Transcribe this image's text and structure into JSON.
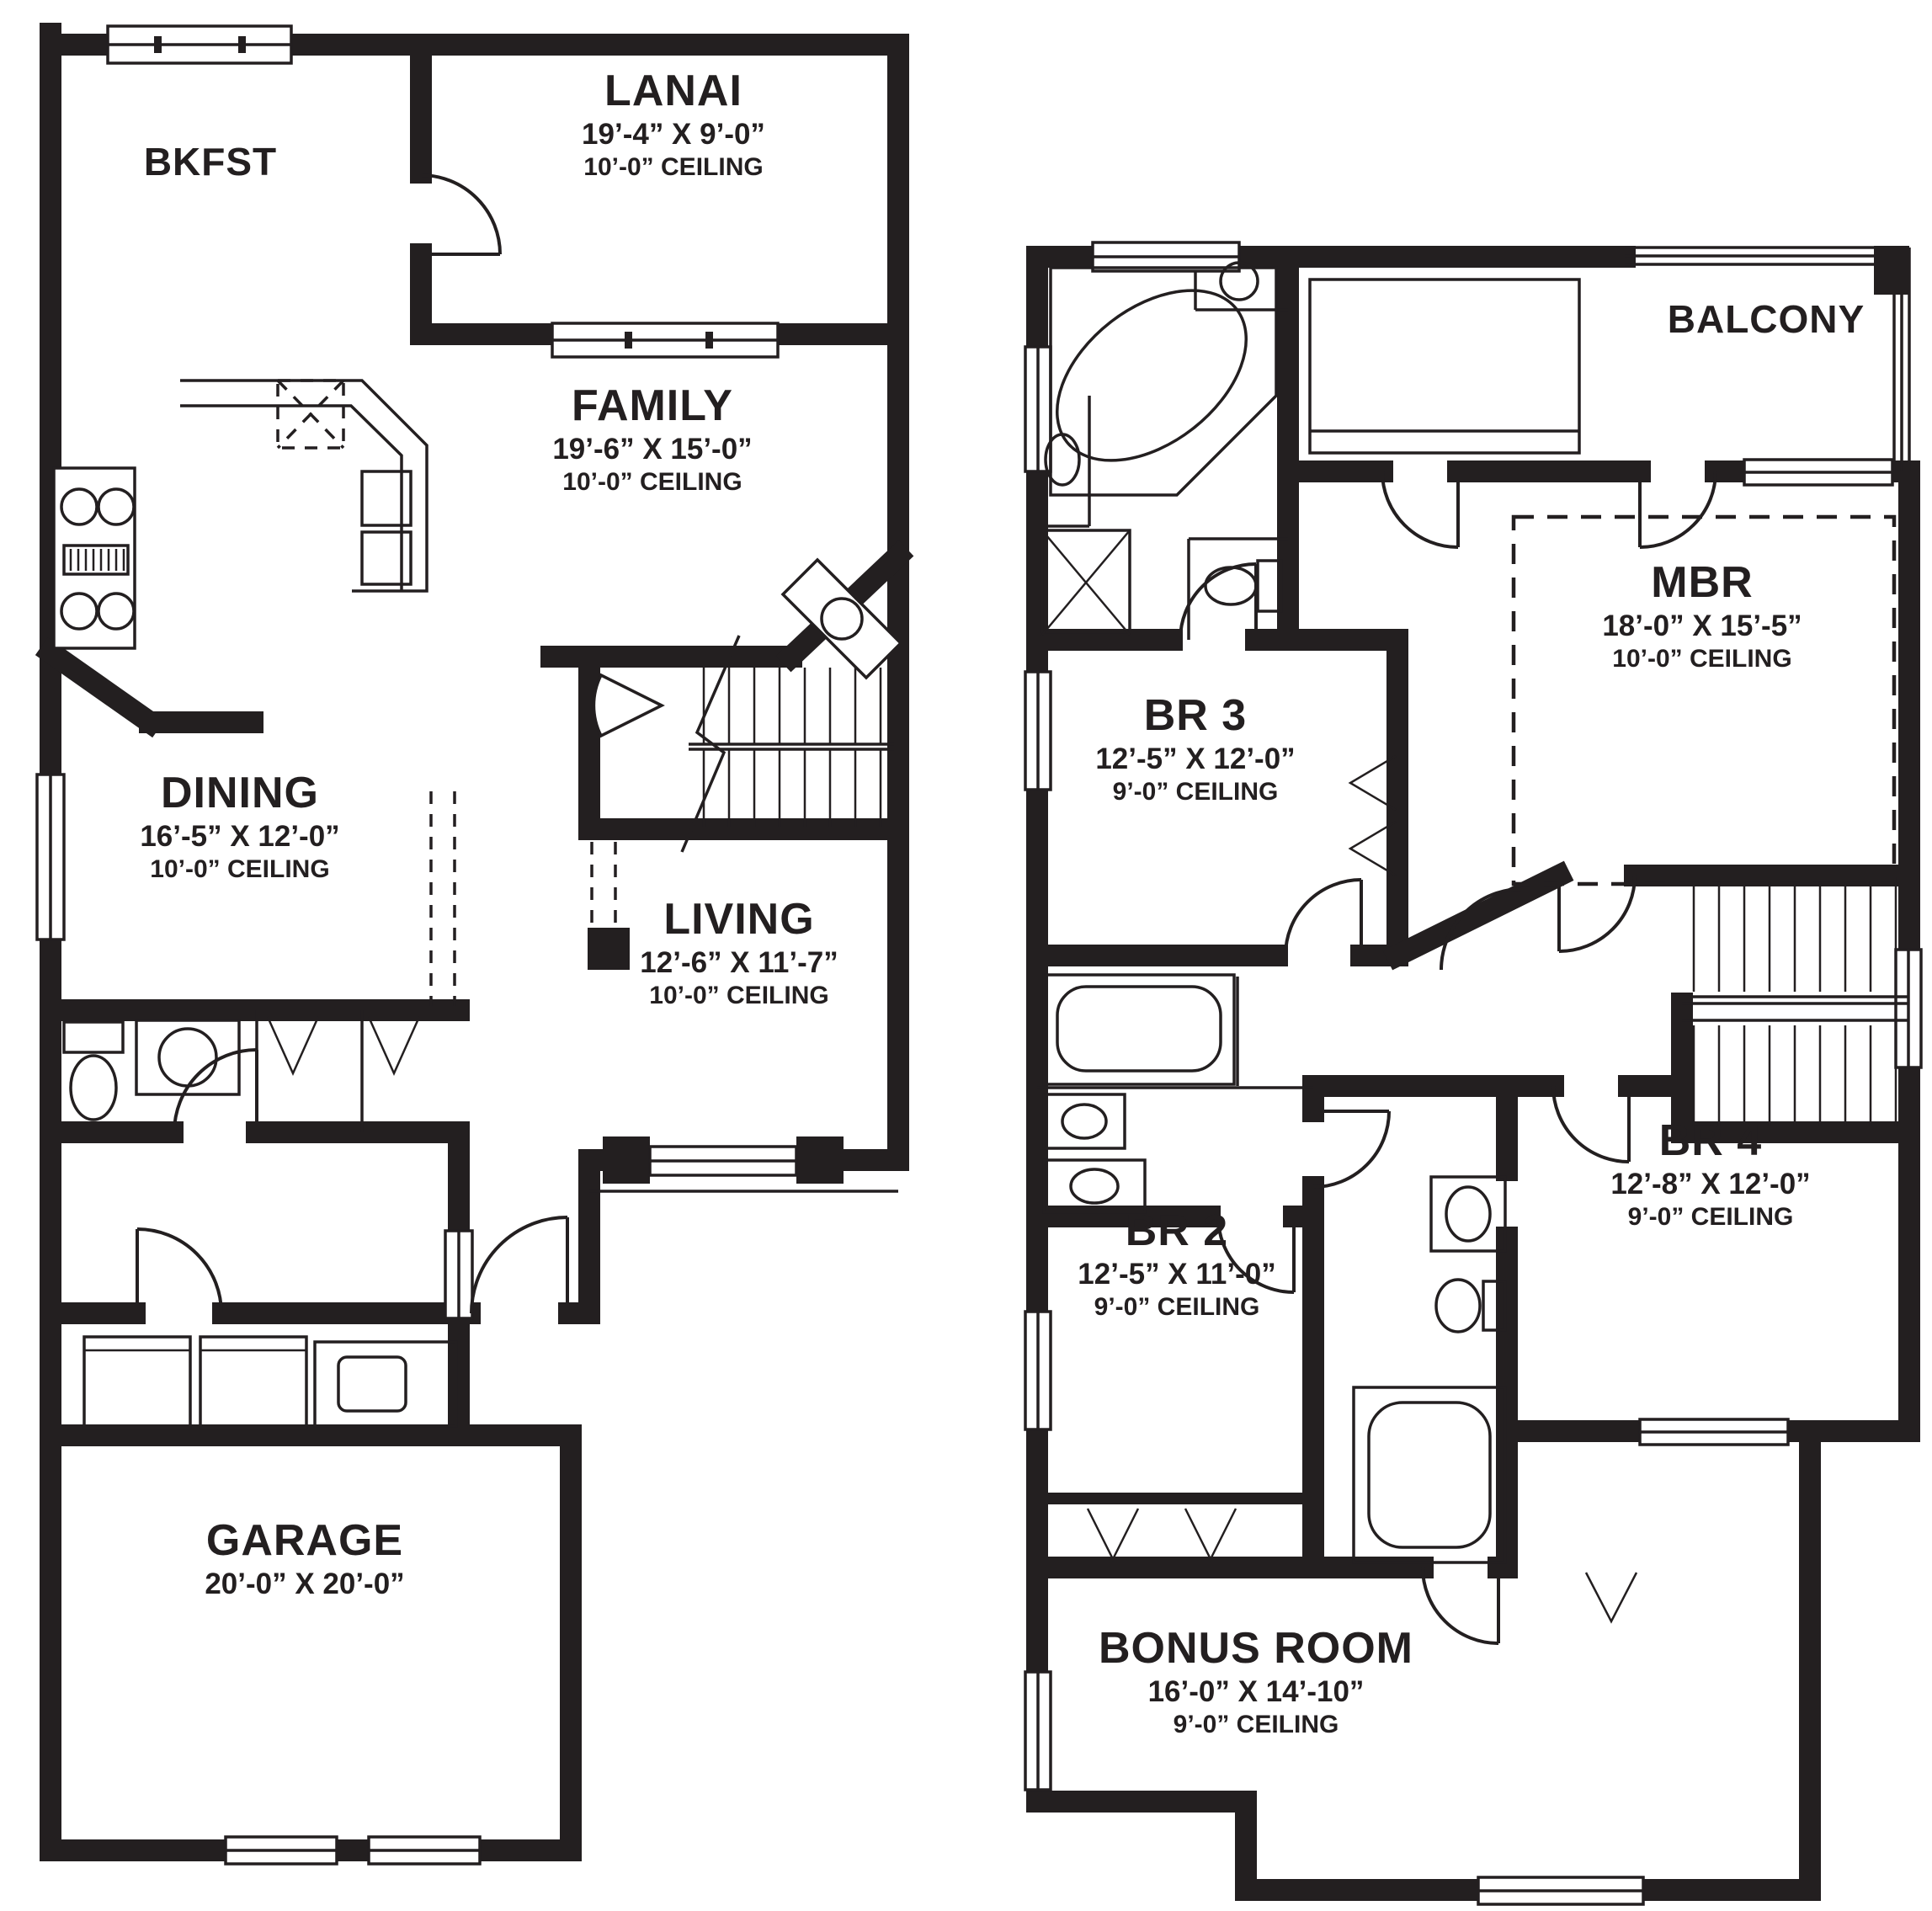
{
  "document": {
    "type": "two-story house floor plan",
    "colors": {
      "wall": "#231f20",
      "background": "#ffffff",
      "text": "#231f20"
    }
  },
  "floors": {
    "first": {
      "rooms": {
        "bkfst": {
          "name": "BKFST"
        },
        "lanai": {
          "name": "LANAI",
          "dims": "19’-4” X 9’-0”",
          "ceiling": "10’-0” CEILING"
        },
        "family": {
          "name": "FAMILY",
          "dims": "19’-6” X 15’-0”",
          "ceiling": "10’-0” CEILING"
        },
        "dining": {
          "name": "DINING",
          "dims": "16’-5” X 12’-0”",
          "ceiling": "10’-0” CEILING"
        },
        "living": {
          "name": "LIVING",
          "dims": "12’-6” X 11’-7”",
          "ceiling": "10’-0” CEILING"
        },
        "garage": {
          "name": "GARAGE",
          "dims": "20’-0” X 20’-0”"
        }
      }
    },
    "second": {
      "rooms": {
        "balcony": {
          "name": "BALCONY"
        },
        "mbr": {
          "name": "MBR",
          "dims": "18’-0” X 15’-5”",
          "ceiling": "10’-0” CEILING"
        },
        "br3": {
          "name": "BR 3",
          "dims": "12’-5” X 12’-0”",
          "ceiling": "9’-0” CEILING"
        },
        "br2": {
          "name": "BR 2",
          "dims": "12’-5” X 11’-0”",
          "ceiling": "9’-0” CEILING"
        },
        "br4": {
          "name": "BR 4",
          "dims": "12’-8” X 12’-0”",
          "ceiling": "9’-0” CEILING"
        },
        "bonus": {
          "name": "BONUS ROOM",
          "dims": "16’-0” X 14’-10”",
          "ceiling": "9’-0” CEILING"
        }
      }
    }
  }
}
